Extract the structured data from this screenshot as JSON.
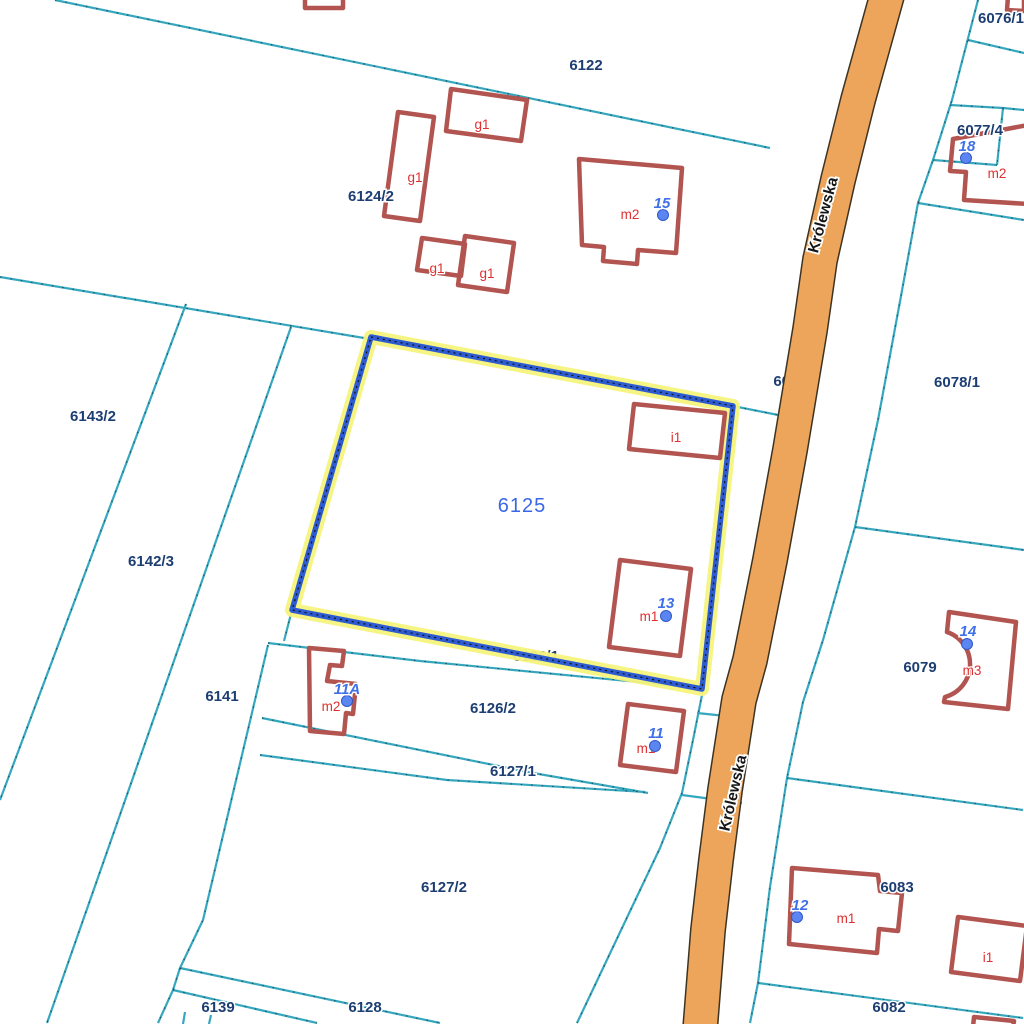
{
  "map_title": "Cadastral parcel map",
  "road": {
    "name": "Królewska",
    "parcel_number": "6080"
  },
  "selected_parcel": {
    "number": "6125"
  },
  "parcel_labels": {
    "6122": "6122",
    "6124_2": "6124/2",
    "6143_2": "6143/2",
    "6142_3": "6142/3",
    "6141": "6141",
    "6126_1": "6126/1",
    "6126_2": "6126/2",
    "6127_1": "6127/1",
    "6127_2": "6127/2",
    "6128": "6128",
    "6139": "6139",
    "6076_1": "6076/1",
    "6077_4": "6077/4",
    "6078_1": "6078/1",
    "6079": "6079",
    "6083": "6083",
    "6082": "6082"
  },
  "building_labels": {
    "g1": "g1",
    "m1": "m1",
    "m2": "m2",
    "m3": "m3",
    "i1": "i1"
  },
  "addresses": {
    "a15": "15",
    "a18": "18",
    "a13": "13",
    "a11A": "11A",
    "a11": "11",
    "a12": "12",
    "a14": "14"
  },
  "colors": {
    "boundary_teal": "#35a8bf",
    "road_orange": "#eda45b",
    "selection_blue": "#2d5bd1",
    "selection_halo_yellow": "#f6f37c",
    "building_red": "#b25450",
    "building_label_red": "#e02f2f",
    "parcel_label_navy": "#1d3e72",
    "address_blue": "#4070e8",
    "road_label_black": "#161616"
  }
}
